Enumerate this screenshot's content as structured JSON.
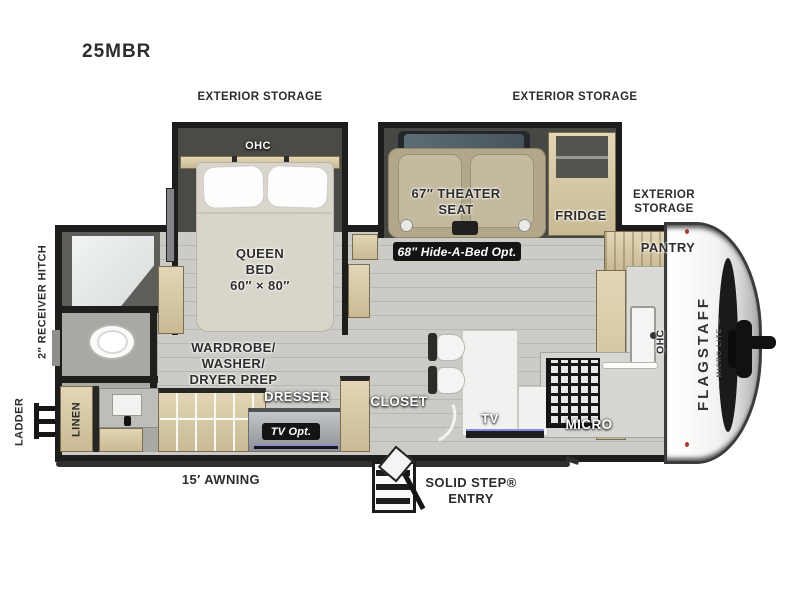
{
  "title": "25MBR",
  "colors": {
    "wall": "#1f1f1e",
    "floor": "#c8c7c2",
    "wood": "#d7c9a6",
    "slide_interior": "#4a4a47",
    "seat_fabric": "#b2a78a",
    "badge_bg": "#141414",
    "front_cap": "#f5f5f3"
  },
  "exterior": {
    "storage_label": "EXTERIOR STORAGE",
    "receiver_hitch": "2″ RECEIVER HITCH",
    "ladder": "LADDER",
    "awning": "15′ AWNING",
    "entry_line1": "SOLID STEP®",
    "entry_line2": "ENTRY",
    "brand": "FLAGSTAFF",
    "brand_sub": "— MICRO LITE —"
  },
  "bedroom": {
    "ohc": "OHC",
    "bed_line1": "QUEEN",
    "bed_line2": "BED",
    "bed_size": "60″ × 80″",
    "wardrobe_line1": "WARDROBE/",
    "wardrobe_line2": "WASHER/",
    "wardrobe_line3": "DRYER PREP",
    "dresser": "DRESSER",
    "tv_opt": "TV Opt.",
    "closet": "CLOSET"
  },
  "living": {
    "theater_line1": "67″ THEATER",
    "theater_line2": "SEAT",
    "hide_a_bed": "68″ Hide-A-Bed Opt.",
    "tv": "TV"
  },
  "kitchen": {
    "fridge": "FRIDGE",
    "pantry": "PANTRY",
    "ohc": "OHC",
    "micro": "MICRO"
  },
  "bathroom": {
    "linen": "LINEN"
  }
}
